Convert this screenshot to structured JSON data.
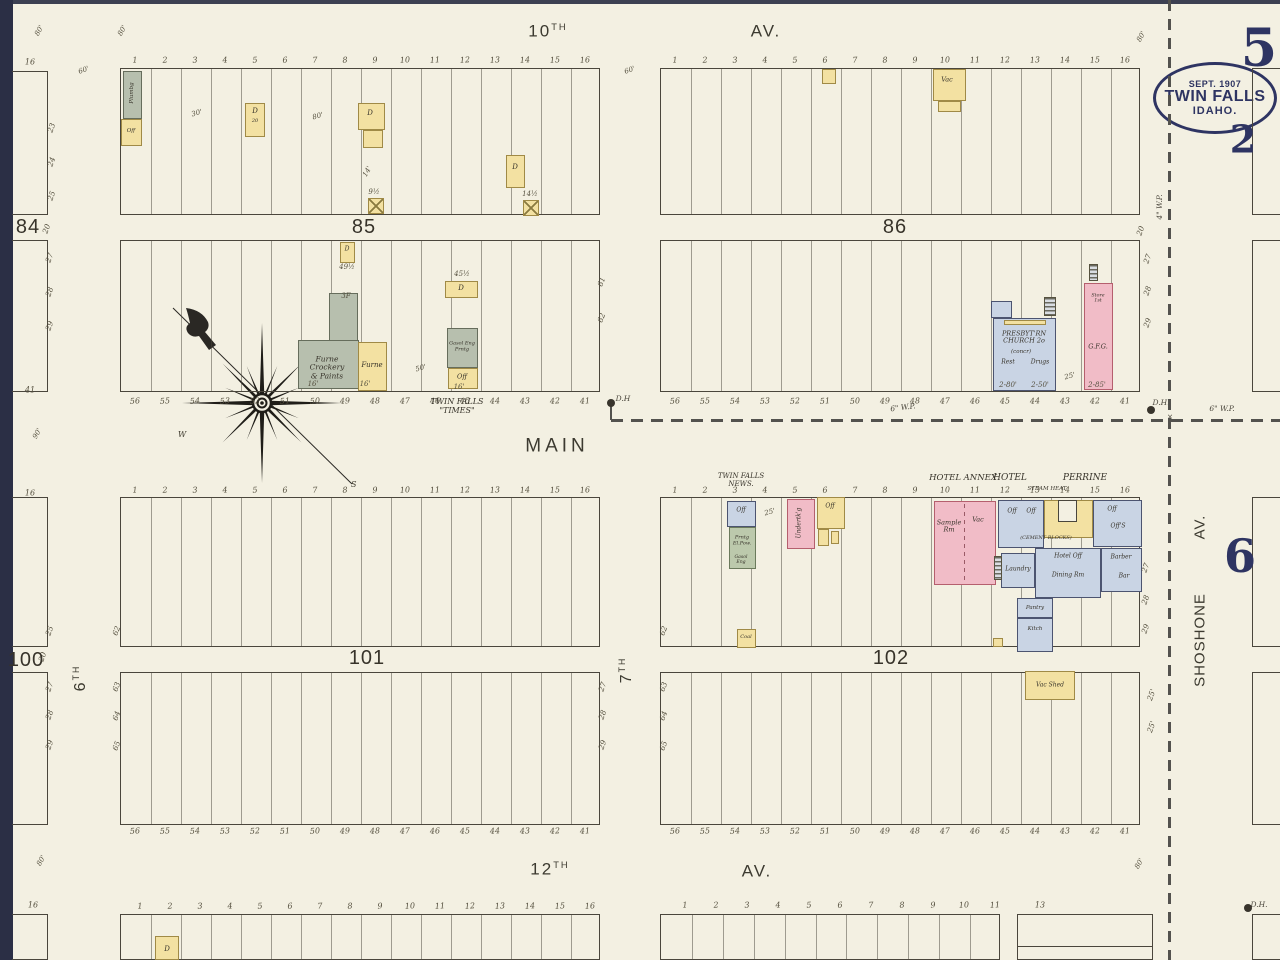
{
  "title_stamp": {
    "line1": "SEPT. 1907",
    "line2": "TWIN FALLS",
    "line3": "IDAHO."
  },
  "big_numbers": [
    [
      "5",
      1259,
      49,
      52
    ],
    [
      "2",
      1243,
      140,
      38
    ],
    [
      "6",
      1240,
      557,
      46
    ]
  ],
  "colors": {
    "paper": "#f3f0e2",
    "ink": "#4a463c",
    "navy": "#2e3462",
    "yellow": "#f3e1a2",
    "yellow_border": "#a08a46",
    "pink": "#f1bcc7",
    "pink_border": "#b55f6e",
    "blue": "#c9d4e4",
    "blue_border": "#4c5470",
    "gray": "#b7bfae",
    "gray_border": "#666d5c",
    "green": "#bcc9ac",
    "green_border": "#6b7a5c"
  },
  "streets": [
    {
      "t": "10",
      "sup": "TH",
      "x": 548,
      "y": 31,
      "s": 17
    },
    {
      "t": "AV.",
      "x": 766,
      "y": 31,
      "s": 17
    },
    {
      "t": "MAIN",
      "x": 557,
      "y": 446,
      "s": 19,
      "ls": 4
    },
    {
      "t": "12",
      "sup": "TH",
      "x": 550,
      "y": 869,
      "s": 17
    },
    {
      "t": "AV.",
      "x": 757,
      "y": 871,
      "s": 17
    },
    {
      "t": "6",
      "sup": "TH",
      "x": 81,
      "y": 678,
      "s": 16,
      "r": -90
    },
    {
      "t": "7",
      "sup": "TH",
      "x": 627,
      "y": 670,
      "s": 16,
      "r": -90
    },
    {
      "t": "SHOSHONE",
      "x": 1201,
      "y": 640,
      "s": 15,
      "r": -90,
      "ls": 1
    },
    {
      "t": "AV.",
      "x": 1201,
      "y": 527,
      "s": 15,
      "r": -90,
      "ls": 1
    }
  ],
  "block_labels": [
    [
      "84",
      28,
      227
    ],
    [
      "85",
      364,
      227
    ],
    [
      "86",
      895,
      227
    ],
    [
      "100",
      26,
      660
    ],
    [
      "101",
      367,
      658
    ],
    [
      "102",
      891,
      658
    ]
  ],
  "blocks": [
    {
      "x": 120,
      "y": 68,
      "w": 480,
      "h": 147,
      "d": 16
    },
    {
      "x": 660,
      "y": 68,
      "w": 480,
      "h": 147,
      "d": 16
    },
    {
      "x": 120,
      "y": 240,
      "w": 480,
      "h": 152,
      "d": 16
    },
    {
      "x": 660,
      "y": 240,
      "w": 480,
      "h": 152,
      "d": 16
    },
    {
      "x": 120,
      "y": 497,
      "w": 480,
      "h": 150,
      "d": 16
    },
    {
      "x": 660,
      "y": 497,
      "w": 480,
      "h": 150,
      "d": 16
    },
    {
      "x": 120,
      "y": 672,
      "w": 480,
      "h": 153,
      "d": 16
    },
    {
      "x": 660,
      "y": 672,
      "w": 480,
      "h": 153,
      "d": 16
    },
    {
      "x": 120,
      "y": 914,
      "w": 480,
      "h": 46,
      "d": 16
    },
    {
      "x": 660,
      "y": 914,
      "w": 340,
      "h": 46,
      "d": 11
    },
    {
      "x": 1017,
      "y": 914,
      "w": 136,
      "h": 46,
      "d": 1
    },
    {
      "x": 1017,
      "y": 946,
      "w": 136,
      "h": 0,
      "d": 0,
      "b": "t"
    },
    {
      "x": 12,
      "y": 71,
      "w": 36,
      "h": 144,
      "d": 0,
      "b": "trb"
    },
    {
      "x": 12,
      "y": 240,
      "w": 36,
      "h": 152,
      "d": 0,
      "b": "trb"
    },
    {
      "x": 12,
      "y": 497,
      "w": 36,
      "h": 150,
      "d": 0,
      "b": "trb"
    },
    {
      "x": 12,
      "y": 672,
      "w": 36,
      "h": 153,
      "d": 0,
      "b": "trb"
    },
    {
      "x": 12,
      "y": 914,
      "w": 36,
      "h": 46,
      "d": 0,
      "b": "trb"
    },
    {
      "x": 1252,
      "y": 68,
      "w": 30,
      "h": 147,
      "d": 0,
      "b": "tlb"
    },
    {
      "x": 1252,
      "y": 240,
      "w": 30,
      "h": 152,
      "d": 0,
      "b": "tlb"
    },
    {
      "x": 1252,
      "y": 497,
      "w": 30,
      "h": 150,
      "d": 0,
      "b": "tlb"
    },
    {
      "x": 1252,
      "y": 672,
      "w": 30,
      "h": 153,
      "d": 0,
      "b": "tlb"
    },
    {
      "x": 1252,
      "y": 914,
      "w": 30,
      "h": 46,
      "d": 0,
      "b": "tlb"
    }
  ],
  "lot_rows": [
    {
      "x0": 135,
      "step": 30,
      "y": 61,
      "vals": [
        "1",
        "2",
        "3",
        "4",
        "5",
        "6",
        "7",
        "8",
        "9",
        "10",
        "11",
        "12",
        "13",
        "14",
        "15",
        "16"
      ]
    },
    {
      "x0": 675,
      "step": 30,
      "y": 61,
      "vals": [
        "1",
        "2",
        "3",
        "4",
        "5",
        "6",
        "7",
        "8",
        "9",
        "10",
        "11",
        "12",
        "13",
        "14",
        "15",
        "16"
      ]
    },
    {
      "x0": 135,
      "step": 30,
      "y": 402,
      "vals": [
        "56",
        "55",
        "54",
        "53",
        "52",
        "51",
        "50",
        "49",
        "48",
        "47",
        "46",
        "45",
        "44",
        "43",
        "42",
        "41"
      ]
    },
    {
      "x0": 675,
      "step": 30,
      "y": 402,
      "vals": [
        "56",
        "55",
        "54",
        "53",
        "52",
        "51",
        "50",
        "49",
        "48",
        "47",
        "46",
        "45",
        "44",
        "43",
        "42",
        "41"
      ]
    },
    {
      "x0": 135,
      "step": 30,
      "y": 491,
      "vals": [
        "1",
        "2",
        "3",
        "4",
        "5",
        "6",
        "7",
        "8",
        "9",
        "10",
        "11",
        "12",
        "13",
        "14",
        "15",
        "16"
      ]
    },
    {
      "x0": 675,
      "step": 30,
      "y": 491,
      "vals": [
        "1",
        "2",
        "3",
        "4",
        "5",
        "6",
        "7",
        "8",
        "9",
        "10",
        "11",
        "12",
        "13",
        "14",
        "15",
        "16"
      ]
    },
    {
      "x0": 135,
      "step": 30,
      "y": 832,
      "vals": [
        "56",
        "55",
        "54",
        "53",
        "52",
        "51",
        "50",
        "49",
        "48",
        "47",
        "46",
        "45",
        "44",
        "43",
        "42",
        "41"
      ]
    },
    {
      "x0": 675,
      "step": 30,
      "y": 832,
      "vals": [
        "56",
        "55",
        "54",
        "53",
        "52",
        "51",
        "50",
        "49",
        "48",
        "47",
        "46",
        "45",
        "44",
        "43",
        "42",
        "41"
      ]
    },
    {
      "x0": 140,
      "step": 30,
      "y": 907,
      "vals": [
        "1",
        "2",
        "3",
        "4",
        "5",
        "6",
        "7",
        "8",
        "9",
        "10",
        "11",
        "12",
        "13",
        "14",
        "15",
        "16"
      ]
    },
    {
      "x0": 685,
      "step": 31,
      "y": 906,
      "vals": [
        "1",
        "2",
        "3",
        "4",
        "5",
        "6",
        "7",
        "8",
        "9",
        "10",
        "11"
      ]
    }
  ],
  "lots_single": [
    [
      "16",
      30,
      63
    ],
    [
      "41",
      30,
      391
    ],
    [
      "16",
      30,
      494
    ],
    [
      "16",
      33,
      906
    ],
    [
      "13",
      1040,
      906
    ]
  ],
  "side_numbers": [
    [
      "23",
      52,
      128
    ],
    [
      "24",
      52,
      162
    ],
    [
      "25",
      52,
      196
    ],
    [
      "20",
      47,
      229
    ],
    [
      "27",
      50,
      258
    ],
    [
      "28",
      50,
      292
    ],
    [
      "29",
      50,
      326
    ],
    [
      "25",
      50,
      631
    ],
    [
      "20",
      43,
      657
    ],
    [
      "27",
      50,
      687
    ],
    [
      "28",
      50,
      715
    ],
    [
      "29",
      50,
      745
    ],
    [
      "62",
      117,
      631
    ],
    [
      "63",
      117,
      687
    ],
    [
      "64",
      117,
      716
    ],
    [
      "65",
      117,
      746
    ],
    [
      "27",
      603,
      687
    ],
    [
      "28",
      603,
      715
    ],
    [
      "29",
      603,
      745
    ],
    [
      "62",
      664,
      631
    ],
    [
      "63",
      664,
      687
    ],
    [
      "64",
      664,
      716
    ],
    [
      "65",
      664,
      746
    ],
    [
      "61",
      602,
      282
    ],
    [
      "62",
      602,
      318
    ],
    [
      "20",
      1141,
      231
    ],
    [
      "27",
      1148,
      259
    ],
    [
      "28",
      1148,
      291
    ],
    [
      "29",
      1148,
      323
    ],
    [
      "27",
      1146,
      568
    ],
    [
      "28",
      1146,
      600
    ],
    [
      "29",
      1146,
      629
    ],
    [
      "25'",
      1152,
      695
    ],
    [
      "25'",
      1152,
      727
    ]
  ],
  "dims": [
    [
      "80'",
      40,
      31,
      -60
    ],
    [
      "80'",
      123,
      31,
      -60
    ],
    [
      "60'",
      84,
      71,
      -20
    ],
    [
      "60'",
      630,
      71,
      -20
    ],
    [
      "80'",
      1142,
      37,
      -60
    ],
    [
      "90'",
      38,
      434,
      -60
    ],
    [
      "30'",
      197,
      114,
      -15
    ],
    [
      "80'",
      318,
      117,
      -15
    ],
    [
      "14'",
      368,
      172,
      -60
    ],
    [
      "50'",
      421,
      369,
      -15
    ],
    [
      "9½",
      374,
      193,
      0
    ],
    [
      "14½",
      530,
      195,
      0
    ],
    [
      "49½",
      347,
      268,
      0
    ],
    [
      "45½",
      462,
      275,
      0
    ],
    [
      "16'",
      313,
      385,
      0
    ],
    [
      "16'",
      365,
      385,
      0
    ],
    [
      "16'",
      459,
      388,
      0
    ],
    [
      "25'",
      770,
      513,
      -15
    ],
    [
      "25'",
      1070,
      377,
      -15
    ],
    [
      "3F",
      346,
      297,
      0
    ],
    [
      "2-80'",
      1008,
      386,
      0
    ],
    [
      "2-50'",
      1040,
      386,
      0
    ],
    [
      "2-85'",
      1097,
      386,
      0
    ],
    [
      "80'",
      42,
      861,
      -60
    ],
    [
      "80'",
      1140,
      864,
      -60
    ]
  ],
  "buildings": [
    {
      "x": 123,
      "y": 71,
      "w": 19,
      "h": 48,
      "f": "g"
    },
    {
      "x": 121,
      "y": 119,
      "w": 21,
      "h": 27,
      "f": "y"
    },
    {
      "x": 245,
      "y": 103,
      "w": 20,
      "h": 34,
      "f": "y"
    },
    {
      "x": 358,
      "y": 103,
      "w": 27,
      "h": 27,
      "f": "y"
    },
    {
      "x": 363,
      "y": 130,
      "w": 20,
      "h": 18,
      "f": "y"
    },
    {
      "x": 506,
      "y": 155,
      "w": 19,
      "h": 33,
      "f": "y"
    },
    {
      "x": 368,
      "y": 198,
      "w": 16,
      "h": 16,
      "f": "y",
      "xm": true
    },
    {
      "x": 523,
      "y": 200,
      "w": 16,
      "h": 16,
      "f": "y",
      "xm": true
    },
    {
      "x": 340,
      "y": 242,
      "w": 15,
      "h": 21,
      "f": "y"
    },
    {
      "x": 329,
      "y": 293,
      "w": 29,
      "h": 48,
      "f": "g"
    },
    {
      "x": 298,
      "y": 340,
      "w": 61,
      "h": 49,
      "f": "g"
    },
    {
      "x": 358,
      "y": 342,
      "w": 29,
      "h": 49,
      "f": "y"
    },
    {
      "x": 445,
      "y": 281,
      "w": 33,
      "h": 17,
      "f": "y"
    },
    {
      "x": 447,
      "y": 328,
      "w": 31,
      "h": 40,
      "f": "g"
    },
    {
      "x": 448,
      "y": 368,
      "w": 30,
      "h": 21,
      "f": "y"
    },
    {
      "x": 822,
      "y": 69,
      "w": 14,
      "h": 15,
      "f": "y"
    },
    {
      "x": 933,
      "y": 69,
      "w": 33,
      "h": 32,
      "f": "y"
    },
    {
      "x": 938,
      "y": 101,
      "w": 23,
      "h": 11,
      "f": "y"
    },
    {
      "x": 991,
      "y": 301,
      "w": 21,
      "h": 17,
      "f": "b"
    },
    {
      "x": 993,
      "y": 318,
      "w": 63,
      "h": 73,
      "f": "b"
    },
    {
      "x": 1004,
      "y": 320,
      "w": 42,
      "h": 5,
      "f": "y"
    },
    {
      "x": 1084,
      "y": 283,
      "w": 29,
      "h": 107,
      "f": "p"
    },
    {
      "x": 727,
      "y": 501,
      "w": 29,
      "h": 26,
      "f": "b"
    },
    {
      "x": 729,
      "y": 527,
      "w": 27,
      "h": 42,
      "f": "gr"
    },
    {
      "x": 737,
      "y": 629,
      "w": 19,
      "h": 19,
      "f": "y"
    },
    {
      "x": 787,
      "y": 499,
      "w": 28,
      "h": 50,
      "f": "p"
    },
    {
      "x": 817,
      "y": 497,
      "w": 28,
      "h": 32,
      "f": "y"
    },
    {
      "x": 818,
      "y": 529,
      "w": 11,
      "h": 17,
      "f": "y"
    },
    {
      "x": 831,
      "y": 531,
      "w": 8,
      "h": 13,
      "f": "y"
    },
    {
      "x": 934,
      "y": 501,
      "w": 62,
      "h": 84,
      "f": "p"
    },
    {
      "x": 998,
      "y": 500,
      "w": 46,
      "h": 48,
      "f": "b"
    },
    {
      "x": 1044,
      "y": 500,
      "w": 49,
      "h": 38,
      "f": "y"
    },
    {
      "x": 1058,
      "y": 500,
      "w": 19,
      "h": 22,
      "f": "paper"
    },
    {
      "x": 1093,
      "y": 500,
      "w": 49,
      "h": 47,
      "f": "b"
    },
    {
      "x": 1035,
      "y": 548,
      "w": 66,
      "h": 50,
      "f": "b"
    },
    {
      "x": 1001,
      "y": 553,
      "w": 34,
      "h": 35,
      "f": "b"
    },
    {
      "x": 1101,
      "y": 548,
      "w": 41,
      "h": 44,
      "f": "b"
    },
    {
      "x": 1017,
      "y": 598,
      "w": 36,
      "h": 20,
      "f": "b"
    },
    {
      "x": 1017,
      "y": 618,
      "w": 36,
      "h": 34,
      "f": "b"
    },
    {
      "x": 993,
      "y": 638,
      "w": 10,
      "h": 9,
      "f": "y"
    },
    {
      "x": 1025,
      "y": 671,
      "w": 50,
      "h": 29,
      "f": "y"
    },
    {
      "x": 155,
      "y": 936,
      "w": 24,
      "h": 24,
      "f": "y"
    }
  ],
  "hatches": [
    [
      1044,
      297,
      12,
      19
    ],
    [
      1089,
      264,
      9,
      17
    ],
    [
      994,
      556,
      8,
      24
    ]
  ],
  "names": [
    [
      "TWIN FALLS\n\"TIMES\"",
      457,
      407,
      0,
      8
    ],
    [
      "TWIN FALLS\nNEWS.",
      741,
      481,
      0,
      7
    ],
    [
      "HOTEL ANNEX",
      963,
      479,
      0,
      8.5
    ],
    [
      "HOTEL",
      1010,
      478,
      0,
      9
    ],
    [
      "PERRINE",
      1085,
      478,
      0,
      9
    ],
    [
      "STEAM HEAT",
      1047,
      489,
      0,
      5.5
    ],
    [
      "Sample\nRm",
      949,
      527,
      0,
      6.5
    ],
    [
      "Vac",
      978,
      520,
      0,
      6.5
    ],
    [
      "Off",
      1012,
      512,
      0,
      6
    ],
    [
      "Off",
      1031,
      512,
      0,
      6
    ],
    [
      "(CEMENT BLOCKS)",
      1046,
      539,
      0,
      5
    ],
    [
      "Off",
      1112,
      510,
      0,
      6
    ],
    [
      "Off'S",
      1118,
      527,
      0,
      6
    ],
    [
      "Hotel Off",
      1068,
      557,
      0,
      6
    ],
    [
      "Dining Rm",
      1068,
      576,
      0,
      6
    ],
    [
      "Laundry",
      1018,
      570,
      0,
      6
    ],
    [
      "Barber",
      1121,
      558,
      0,
      6
    ],
    [
      "Bar",
      1124,
      577,
      0,
      6
    ],
    [
      "Pantry",
      1035,
      608,
      0,
      5.5
    ],
    [
      "Kitch",
      1035,
      629,
      0,
      5.5
    ],
    [
      "Vac",
      947,
      80,
      0,
      6.5
    ],
    [
      "Vac Shed",
      1050,
      686,
      0,
      6
    ],
    [
      "Coal",
      746,
      638,
      0,
      5
    ],
    [
      "Off",
      741,
      511,
      0,
      6
    ],
    [
      "Prntg\nEl.Pow.",
      742,
      541,
      0,
      5
    ],
    [
      "Gasol\nEng",
      741,
      560,
      0,
      4.6
    ],
    [
      "Off",
      830,
      507,
      0,
      6
    ],
    [
      "Undertk'g",
      800,
      523,
      -90,
      6
    ],
    [
      "Plumbg",
      132,
      93,
      -90,
      5.5
    ],
    [
      "Off",
      131,
      131,
      0,
      5.5
    ],
    [
      "D",
      255,
      112,
      0,
      7
    ],
    [
      "20",
      255,
      122,
      0,
      5
    ],
    [
      "D",
      370,
      114,
      0,
      7
    ],
    [
      "D",
      515,
      168,
      0,
      7
    ],
    [
      "D",
      347,
      250,
      0,
      6
    ],
    [
      "D",
      461,
      289,
      0,
      7
    ],
    [
      "Furne\nCrockery\n& Paints",
      327,
      368,
      0,
      7.5
    ],
    [
      "Furne",
      372,
      366,
      0,
      7
    ],
    [
      "Gasol Eng\nPrntg",
      462,
      347,
      0,
      5
    ],
    [
      "Off",
      462,
      377,
      0,
      6.5
    ],
    [
      "PRESBYT'RN\nCHURCH 2o",
      1024,
      338,
      0,
      6.5
    ],
    [
      "(concr)",
      1021,
      352,
      0,
      5.5
    ],
    [
      "Rest",
      1008,
      363,
      0,
      6
    ],
    [
      "Drugs",
      1040,
      363,
      0,
      6
    ],
    [
      "G.F.G.",
      1098,
      347,
      0,
      6.5
    ],
    [
      "Store\n1st",
      1098,
      299,
      0,
      4.8
    ],
    [
      "D",
      167,
      950,
      0,
      7
    ]
  ],
  "wp_labels": [
    [
      "6\" W.P.",
      903,
      408,
      -7
    ],
    [
      "6\" W.P.",
      1222,
      409,
      0
    ],
    [
      "4\" W.P.",
      1160,
      207,
      -90
    ],
    [
      "D.H",
      623,
      399,
      0
    ],
    [
      "D.H.",
      1161,
      403,
      0
    ],
    [
      "D.H.",
      1259,
      905,
      0
    ],
    [
      "×",
      1170,
      417,
      0
    ]
  ],
  "dashes": [
    {
      "x": 1168,
      "y": 0,
      "l": 960,
      "d": "v"
    },
    {
      "x": 611,
      "y": 419,
      "l": 669,
      "d": "h"
    },
    {
      "x": 964,
      "y": 504,
      "l": 80,
      "d": "vt"
    },
    {
      "x": 610,
      "y": 406,
      "l": 14,
      "d": "vs"
    }
  ],
  "hydrants": [
    [
      611,
      403
    ],
    [
      1151,
      410
    ],
    [
      1248,
      908
    ]
  ],
  "compass": {
    "cx": 262,
    "cy": 403,
    "letters": [
      [
        "W",
        178,
        437
      ],
      [
        "S",
        351,
        487
      ]
    ],
    "needle": [
      173,
      308,
      352,
      484
    ]
  }
}
